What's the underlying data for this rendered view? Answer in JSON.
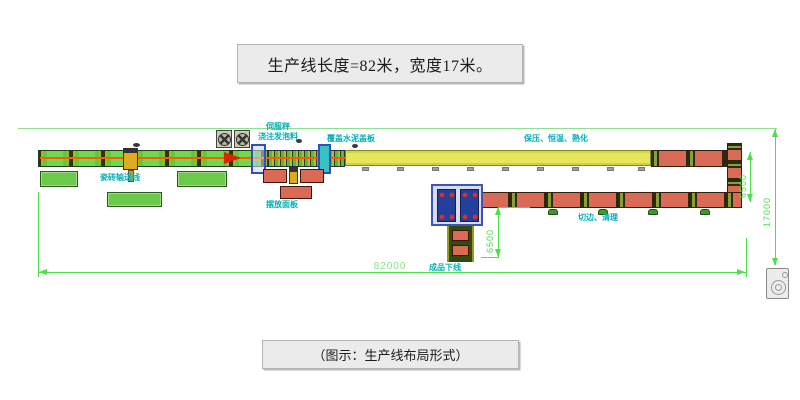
{
  "title": {
    "text": "生产线长度=82米，宽度17米。"
  },
  "caption": {
    "text": "（图示：生产线布局形式）"
  },
  "labels": {
    "tile_conveyor": "瓷砖输送线",
    "metering": "伺服秤",
    "pour_foam": "浇注发泡料",
    "place_panels": "摆放面板",
    "cement_cover": "覆盖水泥盖板",
    "curing": "保压、恒温、熟化",
    "trim_clean": "切边、清理",
    "product_offline": "成品下线"
  },
  "dimensions": {
    "total_length": "82000",
    "total_width": "17000",
    "right_span": "6500",
    "mid_span": "6500"
  },
  "colors": {
    "label_cyan": "#00b0b8",
    "dimension_green": "#4ae04a",
    "conveyor_green": "#6cc94c",
    "block_red": "#d96a55",
    "tunnel_yellow": "#e6e65a",
    "machine_blue": "#3a57b5",
    "flow_arrow_red": "#dd2200"
  }
}
